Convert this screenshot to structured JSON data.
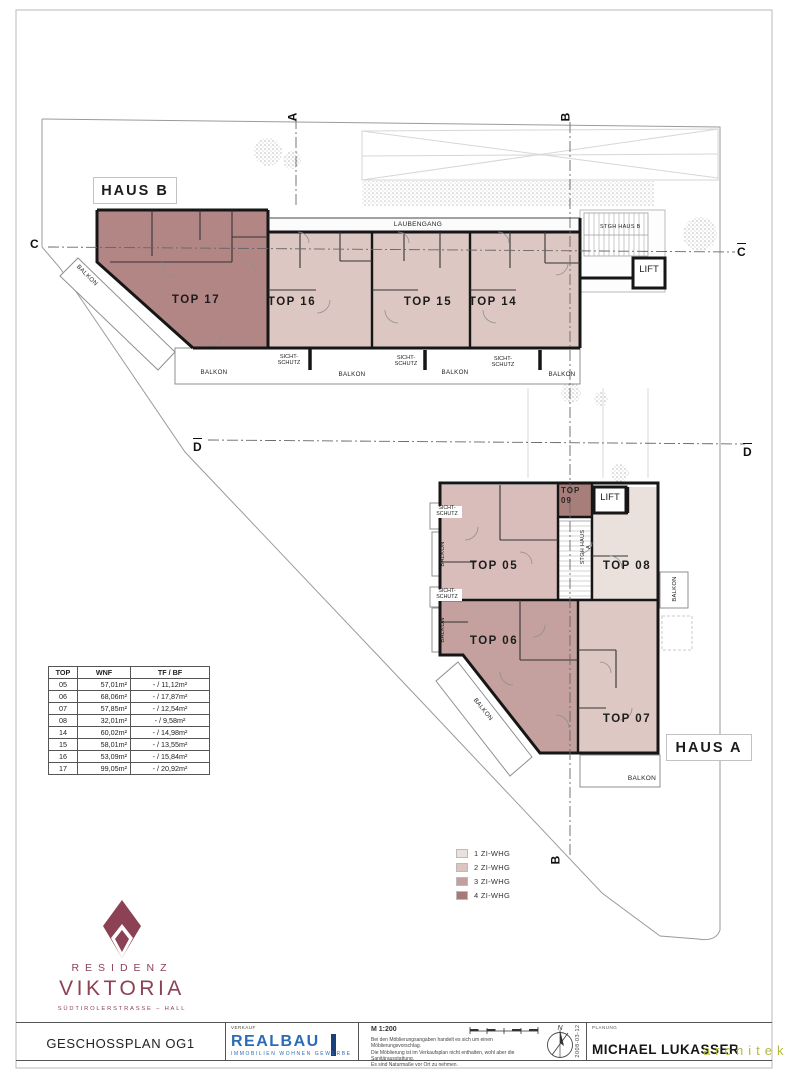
{
  "colors": {
    "accent_maroon": "#8c4154",
    "realbau_blue": "#2c6cb4",
    "realbau_dark": "#1c3e79",
    "architekt_olive": "#b3b93a",
    "wall": "#161616"
  },
  "plan": {
    "haus_b": {
      "label": "HAUS B",
      "corridor": "LAUBENGANG",
      "stairwell": "STGH HAUS B",
      "lift": "LIFT",
      "units": {
        "top17": "TOP 17",
        "top16": "TOP 16",
        "top15": "TOP 15",
        "top14": "TOP 14"
      }
    },
    "haus_a": {
      "label": "HAUS A",
      "stairwell": "STGH HAUS A",
      "lift": "LIFT",
      "units": {
        "top05": "TOP 05",
        "top06": "TOP 06",
        "top07": "TOP 07",
        "top08": "TOP 08",
        "top09": "TOP 09"
      }
    },
    "labels": {
      "balkon": "BALKON",
      "sichtschutz": "SICHT-\nSCHUTZ"
    },
    "sections": {
      "a": "A",
      "b": "B",
      "c": "C",
      "d": "D"
    },
    "unit_fills": {
      "top17": "#b28684",
      "top16": "#ddc7c3",
      "top15": "#ddc7c3",
      "top14": "#ddc7c3",
      "top05": "#d8bdba",
      "top06": "#c4a19e",
      "top07": "#ddc8c4",
      "top08": "#eae0dc",
      "top09": "#a87e7b"
    }
  },
  "area_table": {
    "headers": [
      "TOP",
      "WNF",
      "TF / BF"
    ],
    "rows": [
      [
        "05",
        "57,01m²",
        "- / 11,12m²"
      ],
      [
        "06",
        "68,06m²",
        "- / 17,87m²"
      ],
      [
        "07",
        "57,85m²",
        "- / 12,54m²"
      ],
      [
        "08",
        "32,01m²",
        "- / 9,58m²"
      ],
      [
        "14",
        "60,02m²",
        "- / 14,98m²"
      ],
      [
        "15",
        "58,01m²",
        "- / 13,55m²"
      ],
      [
        "16",
        "53,09m²",
        "- / 15,84m²"
      ],
      [
        "17",
        "99,05m²",
        "- / 20,92m²"
      ]
    ]
  },
  "legend": {
    "items": [
      {
        "label": "1 ZI-WHG",
        "color": "#eae0dc"
      },
      {
        "label": "2 ZI-WHG",
        "color": "#dcc5c1"
      },
      {
        "label": "3 ZI-WHG",
        "color": "#c3a09d"
      },
      {
        "label": "4 ZI-WHG",
        "color": "#a87a77"
      }
    ]
  },
  "branding": {
    "line1": "RESIDENZ",
    "line2": "VIKTORIA",
    "address": "SÜDTIROLERSTRASSE – HALL"
  },
  "titleblock": {
    "plan_title": "GESCHOSSPLAN OG1",
    "verkauf": "VERKAUF",
    "realbau": "REALBAU",
    "realbau_sub": "IMMOBILIEN WOHNEN GEWERBE",
    "scale": "M 1:200",
    "disclaimer": [
      "Bei den Möblierungsangaben handelt es sich um einen Möblierungsvorschlag.",
      "Die Möblierung ist im Verkaufsplan nicht enthalten, wohl aber die Sanitärausstattung.",
      "Es sind Naturmaße vor Ort zu nehmen."
    ],
    "north": "N",
    "date": "2008-03-12",
    "planung": "PLANUNG",
    "architect": "MICHAEL LUKASSER",
    "architekt_word": "architekt"
  }
}
